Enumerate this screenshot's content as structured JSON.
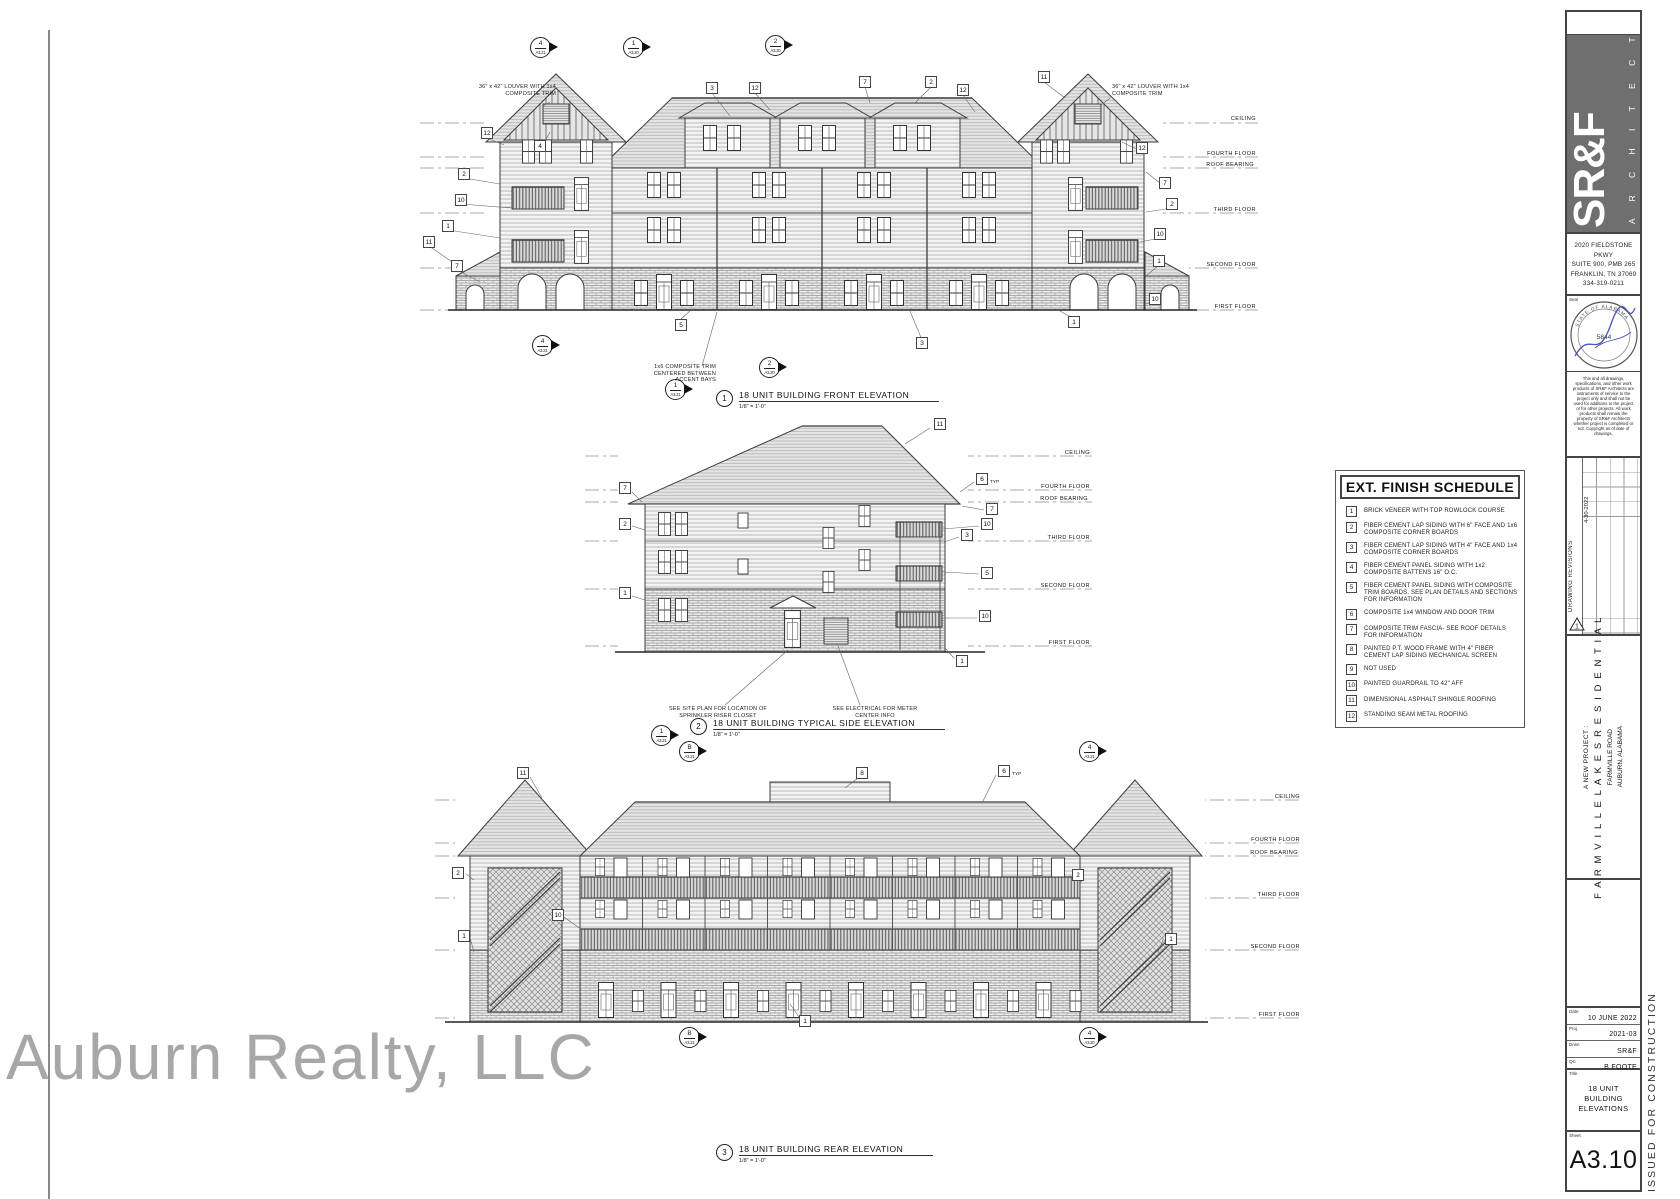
{
  "watermark": "Auburn Realty, LLC",
  "firm": {
    "logo": "SR&F",
    "logo_sub": "A R C H I T E C T S",
    "address_lines": [
      "2020 FIELDSTONE PKWY",
      "SUITE 900, PMB 265",
      "FRANKLIN, TN 37069",
      "334-319-0211"
    ],
    "seal_label": "Seal",
    "seal_arc_top": "STATE OF ALABAMA",
    "seal_number": "5844",
    "disclaimer": "This and all drawings, specifications, and other work products of SR&F Architects are instruments of service to the project only and shall not be used for additions to the project or for other projects. All work products shall remain the property of SR&F Architects whether project is completed or not. Copyright as of date of drawings."
  },
  "revisions": {
    "label": "DRAWING REVISIONS",
    "entry_date": "4-30-2022",
    "delta_number": "1"
  },
  "project": {
    "prefix": "A NEW PROJECT :",
    "name": "F A R M V I L L E   L A K E S   R E S I D E N T I A L",
    "address": "FARMVILLE ROAD",
    "city": "AUBURN, ALABAMA"
  },
  "info": {
    "date_label": "Date",
    "date_value": "10 JUNE 2022",
    "proj_label": "Proj",
    "proj_value": "2021-03",
    "drawn_label": "Drwn",
    "drawn_value": "SR&F",
    "qc_label": "QC",
    "qc_value": "B FOOTE",
    "title_label": "Title",
    "sheet_title": "18 UNIT BUILDING ELEVATIONS",
    "sheet_label": "Sheet",
    "sheet_number": "A3.10",
    "issued_stamp": "ISSUED FOR CONSTRUCTION"
  },
  "schedule": {
    "title": "EXT. FINISH SCHEDULE",
    "items": [
      {
        "num": "1",
        "text": "BRICK VENEER WITH TOP ROWLOCK COURSE"
      },
      {
        "num": "2",
        "text": "FIBER CEMENT LAP SIDING WITH 6\" FACE AND 1x6 COMPOSITE CORNER BOARDS"
      },
      {
        "num": "3",
        "text": "FIBER CEMENT LAP SIDING WITH 4\" FACE AND 1x4 COMPOSITE CORNER BOARDS"
      },
      {
        "num": "4",
        "text": "FIBER CEMENT PANEL SIDING WITH 1x2 COMPOSITE BATTENS 16\" O.C."
      },
      {
        "num": "5",
        "text": "FIBER CEMENT PANEL SIDING WITH COMPOSITE TRIM BOARDS. SEE PLAN DETAILS AND SECTIONS FOR INFORMATION"
      },
      {
        "num": "6",
        "text": "COMPOSITE 1x4 WINDOW AND DOOR TRIM"
      },
      {
        "num": "7",
        "text": "COMPOSITE TRIM FASCIA- SEE ROOF DETAILS FOR INFORMATION"
      },
      {
        "num": "8",
        "text": "PAINTED P.T. WOOD FRAME WITH 4\" FIBER CEMENT LAP SIDING MECHANICAL SCREEN"
      },
      {
        "num": "9",
        "text": "NOT USED"
      },
      {
        "num": "10",
        "text": "PAINTED GUARDRAIL TO 42\" AFF"
      },
      {
        "num": "11",
        "text": "DIMENSIONAL ASPHALT SHINGLE ROOFING"
      },
      {
        "num": "12",
        "text": "STANDING SEAM METAL ROOFING"
      }
    ]
  },
  "elevations": [
    {
      "number": "1",
      "title": "18 UNIT BUILDING FRONT ELEVATION",
      "scale": "1/8\" = 1'-0\""
    },
    {
      "number": "2",
      "title": "18 UNIT BUILDING TYPICAL SIDE ELEVATION",
      "scale": "1/8\" = 1'-0\""
    },
    {
      "number": "3",
      "title": "18 UNIT BUILDING REAR ELEVATION",
      "scale": "1/8\" = 1'-0\""
    }
  ],
  "level_labels": [
    {
      "text": "CEILING",
      "x": 1256,
      "y": 116
    },
    {
      "text": "FOURTH FLOOR",
      "x": 1256,
      "y": 151
    },
    {
      "text": "ROOF  BEARING",
      "x": 1254,
      "y": 162
    },
    {
      "text": "THIRD FLOOR",
      "x": 1256,
      "y": 207
    },
    {
      "text": "SECOND FLOOR",
      "x": 1256,
      "y": 262
    },
    {
      "text": "FIRST FLOOR",
      "x": 1256,
      "y": 304
    },
    {
      "text": "CEILING",
      "x": 1090,
      "y": 450
    },
    {
      "text": "FOURTH FLOOR",
      "x": 1090,
      "y": 484
    },
    {
      "text": "ROOF  BEARING",
      "x": 1088,
      "y": 496
    },
    {
      "text": "THIRD FLOOR",
      "x": 1090,
      "y": 535
    },
    {
      "text": "SECOND FLOOR",
      "x": 1090,
      "y": 583
    },
    {
      "text": "FIRST FLOOR",
      "x": 1090,
      "y": 640
    },
    {
      "text": "CEILING",
      "x": 1300,
      "y": 794
    },
    {
      "text": "FOURTH FLOOR",
      "x": 1300,
      "y": 837
    },
    {
      "text": "ROOF  BEARING",
      "x": 1298,
      "y": 850
    },
    {
      "text": "THIRD FLOOR",
      "x": 1300,
      "y": 892
    },
    {
      "text": "SECOND FLOOR",
      "x": 1300,
      "y": 944
    },
    {
      "text": "FIRST FLOOR",
      "x": 1300,
      "y": 1012
    }
  ],
  "keynotes": [
    {
      "n": "3",
      "x": 712,
      "y": 88
    },
    {
      "n": "12",
      "x": 755,
      "y": 88
    },
    {
      "n": "7",
      "x": 865,
      "y": 82
    },
    {
      "n": "2",
      "x": 931,
      "y": 82
    },
    {
      "n": "12",
      "x": 963,
      "y": 90
    },
    {
      "n": "11",
      "x": 1044,
      "y": 77
    },
    {
      "n": "12",
      "x": 487,
      "y": 133
    },
    {
      "n": "4",
      "x": 540,
      "y": 146
    },
    {
      "n": "2",
      "x": 464,
      "y": 174
    },
    {
      "n": "10",
      "x": 461,
      "y": 200
    },
    {
      "n": "1",
      "x": 448,
      "y": 226
    },
    {
      "n": "11",
      "x": 429,
      "y": 242
    },
    {
      "n": "7",
      "x": 457,
      "y": 266
    },
    {
      "n": "12",
      "x": 1142,
      "y": 148
    },
    {
      "n": "7",
      "x": 1165,
      "y": 183
    },
    {
      "n": "2",
      "x": 1172,
      "y": 204
    },
    {
      "n": "10",
      "x": 1160,
      "y": 234
    },
    {
      "n": "1",
      "x": 1159,
      "y": 261
    },
    {
      "n": "10",
      "x": 1155,
      "y": 299
    },
    {
      "n": "5",
      "x": 681,
      "y": 325
    },
    {
      "n": "1",
      "x": 1074,
      "y": 322
    },
    {
      "n": "3",
      "x": 922,
      "y": 343
    },
    {
      "n": "11",
      "x": 940,
      "y": 424
    },
    {
      "n": "7",
      "x": 625,
      "y": 488
    },
    {
      "n": "2",
      "x": 625,
      "y": 524
    },
    {
      "n": "1",
      "x": 625,
      "y": 593
    },
    {
      "n": "6",
      "x": 982,
      "y": 479,
      "typ": true
    },
    {
      "n": "7",
      "x": 992,
      "y": 509
    },
    {
      "n": "10",
      "x": 987,
      "y": 524
    },
    {
      "n": "3",
      "x": 967,
      "y": 535
    },
    {
      "n": "5",
      "x": 987,
      "y": 573
    },
    {
      "n": "10",
      "x": 985,
      "y": 616
    },
    {
      "n": "1",
      "x": 962,
      "y": 661
    },
    {
      "n": "11",
      "x": 523,
      "y": 773
    },
    {
      "n": "8",
      "x": 862,
      "y": 773
    },
    {
      "n": "6",
      "x": 1004,
      "y": 771,
      "typ": true
    },
    {
      "n": "2",
      "x": 458,
      "y": 873
    },
    {
      "n": "2",
      "x": 1078,
      "y": 875
    },
    {
      "n": "10",
      "x": 558,
      "y": 915
    },
    {
      "n": "1",
      "x": 464,
      "y": 936
    },
    {
      "n": "1",
      "x": 1171,
      "y": 939
    },
    {
      "n": "1",
      "x": 805,
      "y": 1021
    }
  ],
  "notes": [
    {
      "text": "36\" x 42\" LOUVER WITH 1x4 COMPOSITE TRIM",
      "x": 468,
      "y": 84,
      "w": 88,
      "align": "right"
    },
    {
      "text": "36\" x 42\" LOUVER WITH 1x4 COMPOSITE TRIM",
      "x": 1112,
      "y": 84,
      "w": 88,
      "align": "left"
    },
    {
      "text": "1x6 COMPOSITE TRIM CENTERED BETWEEN ACCENT BAYS",
      "x": 636,
      "y": 364,
      "w": 80,
      "align": "right"
    },
    {
      "text": "SEE SITE PLAN FOR LOCATION OF SPRINKLER RISER CLOSET",
      "x": 668,
      "y": 706,
      "w": 100,
      "align": "center"
    },
    {
      "text": "SEE ELECTRICAL FOR METER CENTER INFO",
      "x": 830,
      "y": 706,
      "w": 90,
      "align": "center"
    }
  ],
  "markers": [
    {
      "num": "4",
      "sheet": "A3.21",
      "x": 541,
      "y": 48
    },
    {
      "num": "1",
      "sheet": "A3.20",
      "x": 634,
      "y": 48
    },
    {
      "num": "2",
      "sheet": "A3.20",
      "x": 776,
      "y": 46
    },
    {
      "num": "4",
      "sheet": "A3.21",
      "x": 543,
      "y": 346
    },
    {
      "num": "2",
      "sheet": "A3.20",
      "x": 770,
      "y": 368
    },
    {
      "num": "1",
      "sheet": "A3.21",
      "x": 676,
      "y": 390
    },
    {
      "num": "1",
      "sheet": "A3.21",
      "x": 662,
      "y": 736
    },
    {
      "num": "B",
      "sheet": "A3.21",
      "x": 690,
      "y": 752
    },
    {
      "num": "4",
      "sheet": "A3.21",
      "x": 1090,
      "y": 752
    },
    {
      "num": "B",
      "sheet": "A3.21",
      "x": 690,
      "y": 1038
    },
    {
      "num": "4",
      "sheet": "A3.20",
      "x": 1090,
      "y": 1038
    }
  ]
}
